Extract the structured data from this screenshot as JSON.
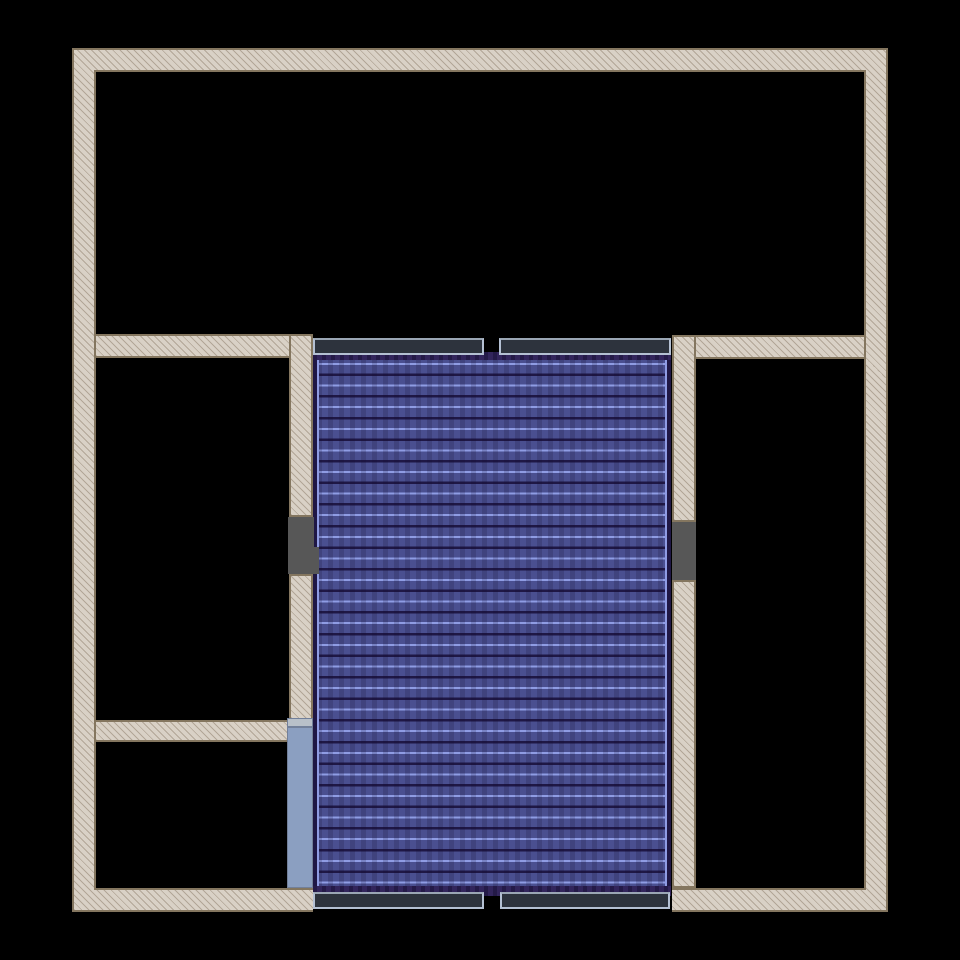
{
  "canvas": {
    "width": 960,
    "height": 960,
    "background": "#000000"
  },
  "palette": {
    "bg": "#000000",
    "wall_fill": "#d9d1c6",
    "wall_hatch": "#b2a697",
    "wall_border": "#84765f",
    "door_fill": "#575757",
    "deck_field": "#4a4f90",
    "deck_light": "#8f9ce4",
    "deck_dark": "#1f1745",
    "deck_edge": "#32255c",
    "deck_edge_dark": "#241a48",
    "ledge_fill": "#2d333d",
    "ledge_border": "#b4c0d3",
    "panel_fill": "#8b9fc1",
    "panel_border": "#72809a",
    "panel_cap": "#b8c0c9"
  },
  "plan": {
    "elements": [
      {
        "name": "outer-wall-frame",
        "type": "frame",
        "x": 72,
        "y": 48,
        "w": 816,
        "h": 864,
        "interactable": true
      },
      {
        "name": "interior-cutout",
        "type": "cut",
        "x": 94,
        "y": 70,
        "w": 772,
        "h": 820,
        "interactable": false
      },
      {
        "name": "bottom-wall-gap",
        "type": "blackout",
        "x": 313,
        "y": 888,
        "w": 359,
        "h": 24,
        "interactable": false
      },
      {
        "name": "wall-left-room-top",
        "type": "wall",
        "x": 94,
        "y": 334,
        "w": 219,
        "h": 24,
        "interactable": true
      },
      {
        "name": "wall-left-partition-upper",
        "type": "wall",
        "x": 289,
        "y": 334,
        "w": 24,
        "h": 183,
        "interactable": true
      },
      {
        "name": "wall-left-partition-lower",
        "type": "wall",
        "x": 289,
        "y": 574,
        "w": 24,
        "h": 146,
        "interactable": true
      },
      {
        "name": "wall-left-room-bottom",
        "type": "wall",
        "x": 94,
        "y": 720,
        "w": 195,
        "h": 22,
        "interactable": true
      },
      {
        "name": "wall-right-room-top",
        "type": "wall",
        "x": 672,
        "y": 335,
        "w": 194,
        "h": 24,
        "interactable": true
      },
      {
        "name": "wall-right-partition-upper",
        "type": "wall",
        "x": 672,
        "y": 335,
        "w": 24,
        "h": 187,
        "interactable": true
      },
      {
        "name": "wall-right-partition-lower",
        "type": "wall",
        "x": 672,
        "y": 580,
        "w": 24,
        "h": 308,
        "interactable": true
      },
      {
        "name": "staircase-plank-deck",
        "type": "deck",
        "x": 313,
        "y": 352,
        "w": 358,
        "h": 544,
        "interactable": true
      },
      {
        "name": "deck-edge-top",
        "type": "deck-edge",
        "x": 313,
        "y": 352,
        "w": 358,
        "h": 8,
        "interactable": false
      },
      {
        "name": "deck-edge-bottom",
        "type": "deck-edge",
        "x": 313,
        "y": 886,
        "w": 358,
        "h": 10,
        "interactable": false
      },
      {
        "name": "railing-top-left",
        "type": "ledge",
        "x": 313,
        "y": 338,
        "w": 171,
        "h": 17,
        "interactable": true
      },
      {
        "name": "railing-top-right",
        "type": "ledge",
        "x": 499,
        "y": 338,
        "w": 172,
        "h": 17,
        "interactable": true
      },
      {
        "name": "railing-bottom-left",
        "type": "ledge",
        "x": 313,
        "y": 892,
        "w": 171,
        "h": 17,
        "interactable": true
      },
      {
        "name": "railing-bottom-right",
        "type": "ledge",
        "x": 500,
        "y": 892,
        "w": 170,
        "h": 17,
        "interactable": true
      },
      {
        "name": "door-opening-left",
        "type": "door",
        "x": 288,
        "y": 517,
        "w": 26,
        "h": 57,
        "interactable": true
      },
      {
        "name": "door-opening-left-notch",
        "type": "door",
        "x": 312,
        "y": 547,
        "w": 7,
        "h": 27,
        "interactable": false
      },
      {
        "name": "door-opening-right",
        "type": "door",
        "x": 672,
        "y": 522,
        "w": 24,
        "h": 58,
        "interactable": true
      },
      {
        "name": "window-panel-cap",
        "type": "panel-cap",
        "x": 287,
        "y": 718,
        "w": 26,
        "h": 9,
        "interactable": false
      },
      {
        "name": "window-panel",
        "type": "panel",
        "x": 287,
        "y": 727,
        "w": 26,
        "h": 161,
        "interactable": true
      }
    ]
  }
}
